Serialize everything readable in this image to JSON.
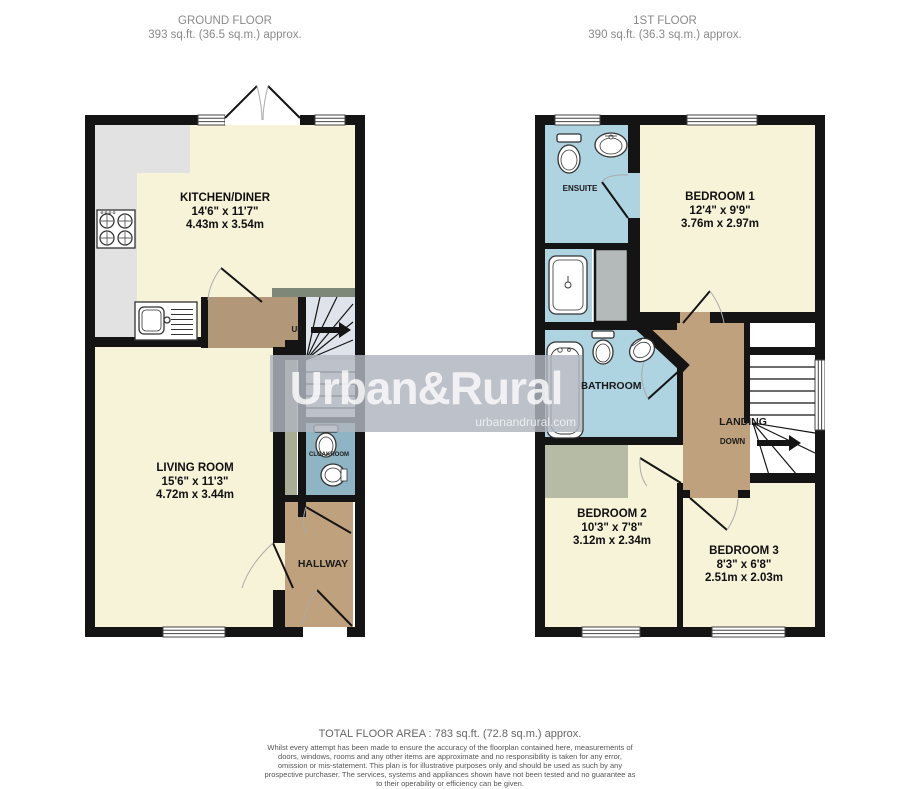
{
  "headers": {
    "ground": {
      "title": "GROUND FLOOR",
      "area": "393 sq.ft. (36.5 sq.m.) approx."
    },
    "first": {
      "title": "1ST FLOOR",
      "area": "390 sq.ft. (36.3 sq.m.) approx."
    }
  },
  "rooms": {
    "kitchen": {
      "name": "KITCHEN/DINER",
      "imperial": "14'6\"  x 11'7\"",
      "metric": "4.43m  x 3.54m"
    },
    "living": {
      "name": "LIVING ROOM",
      "imperial": "15'6\"  x 11'3\"",
      "metric": "4.72m  x 3.44m"
    },
    "hallway": {
      "name": "HALLWAY"
    },
    "cloakroom": {
      "name": "CLOAKROOM"
    },
    "bedroom1": {
      "name": "BEDROOM 1",
      "imperial": "12'4\"  x 9'9\"",
      "metric": "3.76m  x 2.97m"
    },
    "bedroom2": {
      "name": "BEDROOM 2",
      "imperial": "10'3\"  x 7'8\"",
      "metric": "3.12m  x 2.34m"
    },
    "bedroom3": {
      "name": "BEDROOM 3",
      "imperial": "8'3\"  x 6'8\"",
      "metric": "2.51m  x 2.03m"
    },
    "bathroom": {
      "name": "BATHROOM"
    },
    "ensuite": {
      "name": "ENSUITE"
    },
    "landing": {
      "name": "LANDING"
    }
  },
  "stairs": {
    "up": "UP",
    "down": "DOWN"
  },
  "watermark": {
    "brand": "Urban&Rural",
    "site": "urbanandrural.com"
  },
  "footer": {
    "total": "TOTAL FLOOR AREA : 783 sq.ft. (72.8 sq.m.) approx.",
    "disclaimer": "Whilst every attempt has been made to ensure the accuracy of the floorplan contained here, measurements of doors, windows, rooms and any other items are approximate and no responsibility is taken for any error, omission or mis-statement. This plan is for illustrative purposes only and should be used as such by any prospective purchaser. The services, systems and appliances shown have not been tested and no guarantee as to their operability or efficiency can be given.",
    "credit": "Made with Metropix ©2026"
  },
  "colors": {
    "room_cream": "#f7f3d9",
    "hall_brown": "#bfa17e",
    "vestibule_brown": "#b29878",
    "wet_blue": "#aed3e1",
    "cloak_blue": "#8fb5c4",
    "counter_gray": "#e2e2e2",
    "wardrobe_sage": "#b5bba5",
    "cupboard_gray": "#b4baba",
    "stair_gray": "#dfe3eb",
    "wall_black": "#141414",
    "watermark_band": "#b0b5be"
  }
}
